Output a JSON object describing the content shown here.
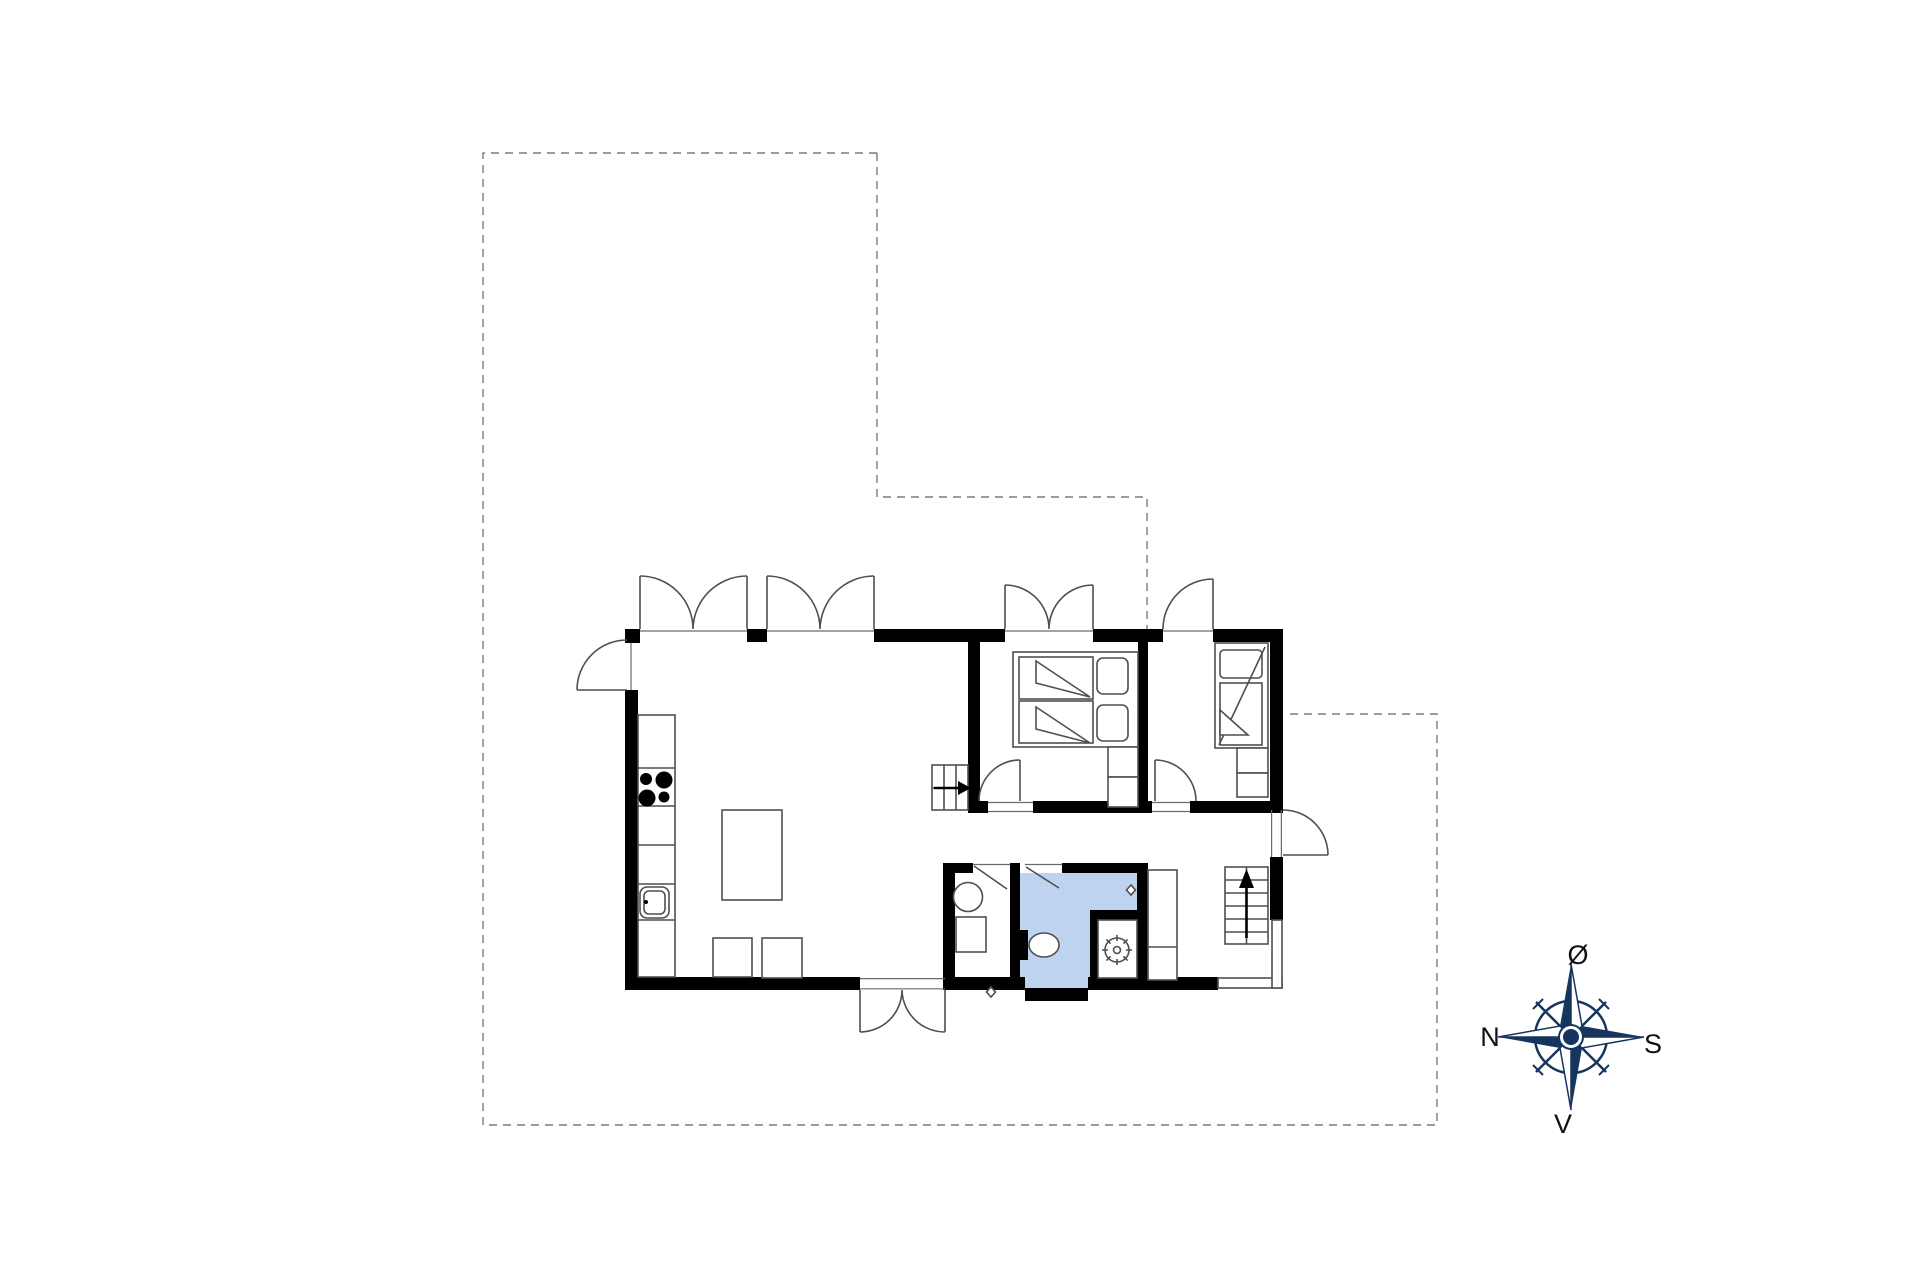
{
  "plan": {
    "kind": "floor-plan-drawing",
    "highlighted_room_color_use": "bathroom"
  },
  "compass": {
    "north": "N",
    "south": "S",
    "east": "Ø",
    "west": "V"
  },
  "colors": {
    "wall_color": "#000000",
    "line_color": "#4f4f4f",
    "dash_color": "#7b7b7b",
    "bathroom_fill": "#bdd3f0",
    "compass_color": "#16355e",
    "label_color": "#111111",
    "background": "#ffffff"
  }
}
